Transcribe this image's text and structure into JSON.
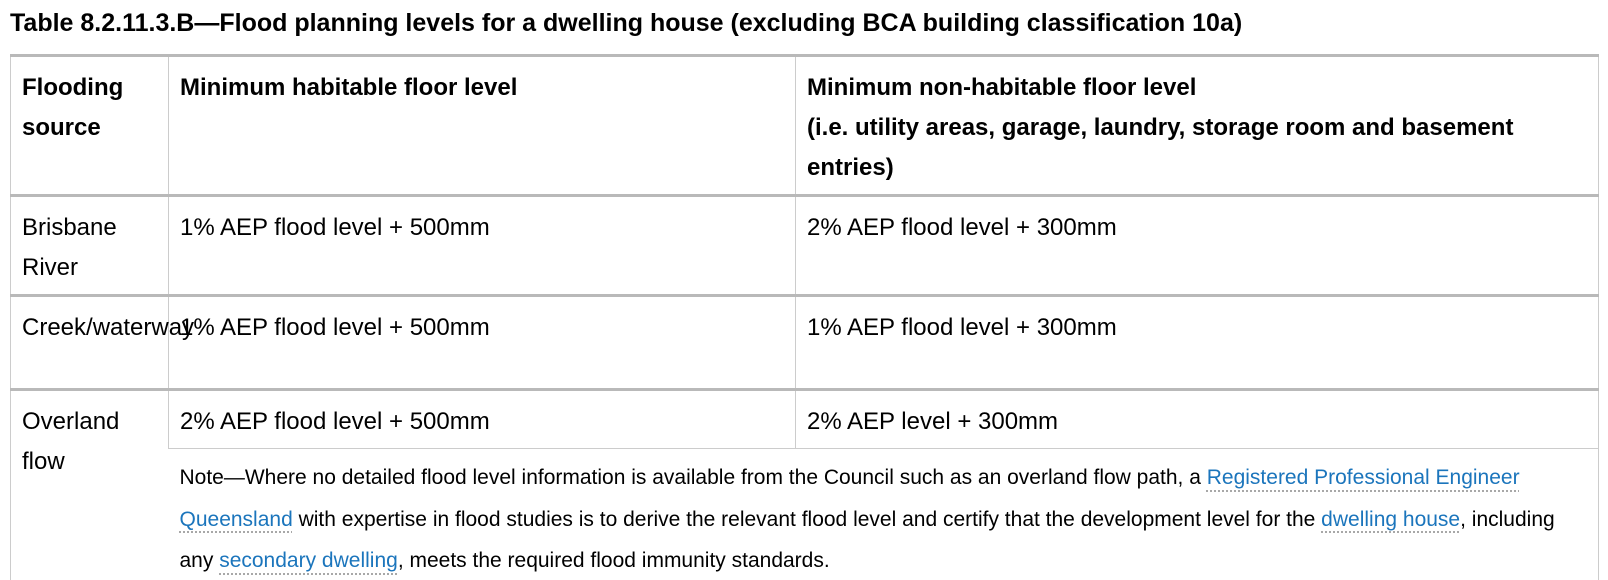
{
  "title": "Table 8.2.11.3.B—Flood planning levels for a dwelling house (excluding BCA building classification 10a)",
  "colors": {
    "link": "#1b75bc",
    "border_thick": "#b9b9b9",
    "border_thin": "#cccccc",
    "text": "#000000"
  },
  "table": {
    "headers": [
      "Flooding source",
      "Minimum habitable floor level",
      "Minimum non-habitable floor level\n(i.e. utility areas, garage, laundry, storage room and basement entries)"
    ],
    "rows": [
      {
        "source": "Brisbane River",
        "habitable": "1% AEP flood level + 500mm",
        "non_habitable": "2% AEP flood level + 300mm"
      },
      {
        "source": "Creek/waterway",
        "habitable": "1% AEP flood level + 500mm",
        "non_habitable": "1% AEP flood level + 300mm"
      },
      {
        "source": "Overland flow",
        "habitable": "2% AEP flood level + 500mm",
        "non_habitable": "2% AEP level + 300mm"
      }
    ],
    "note": {
      "parts": [
        {
          "type": "text",
          "text": "Note—Where no detailed flood level information is available from the Council such as an overland flow path, a "
        },
        {
          "type": "link",
          "text": "Registered Professional Engineer Queensland"
        },
        {
          "type": "text",
          "text": " with expertise in flood studies is to derive the relevant flood level and certify that the development level for the "
        },
        {
          "type": "link",
          "text": "dwelling house"
        },
        {
          "type": "text",
          "text": ", including any "
        },
        {
          "type": "link",
          "text": "secondary dwelling"
        },
        {
          "type": "text",
          "text": ", meets the required flood immunity standards."
        }
      ]
    }
  }
}
